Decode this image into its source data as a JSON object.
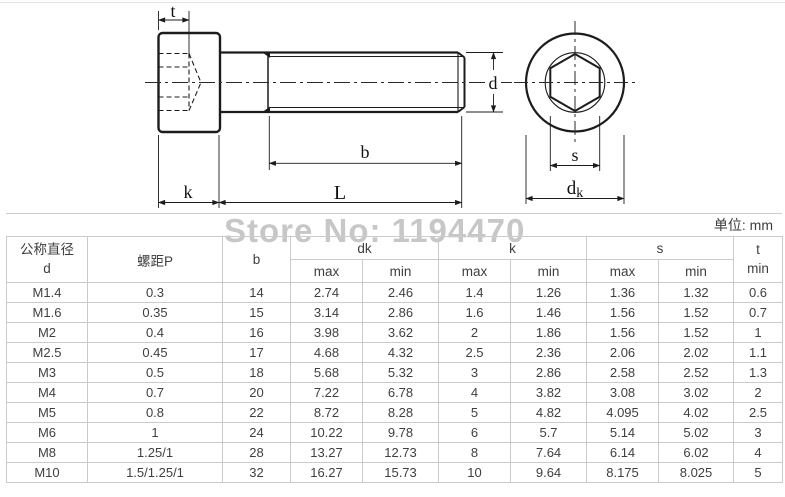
{
  "watermark": {
    "text": "Store No: 1194470",
    "color": "#c7c7c7"
  },
  "units_note": "单位: mm",
  "drawing": {
    "labels": {
      "t": "t",
      "k": "k",
      "l": "L",
      "b": "b",
      "d": "d",
      "s": "s",
      "dk_main": "d",
      "dk_sub": "k"
    }
  },
  "table": {
    "header": {
      "diameter_line1": "公称直径",
      "diameter_line2": "d",
      "pitch": "螺距P",
      "b": "b",
      "group_dk": "dk",
      "group_k": "k",
      "group_s": "s",
      "t_line1": "t",
      "t_line2": "min",
      "max_label": "max",
      "min_label": "min"
    },
    "rows": [
      [
        "M1.4",
        "0.3",
        "14",
        "2.74",
        "2.46",
        "1.4",
        "1.26",
        "1.36",
        "1.32",
        "0.6"
      ],
      [
        "M1.6",
        "0.35",
        "15",
        "3.14",
        "2.86",
        "1.6",
        "1.46",
        "1.56",
        "1.52",
        "0.7"
      ],
      [
        "M2",
        "0.4",
        "16",
        "3.98",
        "3.62",
        "2",
        "1.86",
        "1.56",
        "1.52",
        "1"
      ],
      [
        "M2.5",
        "0.45",
        "17",
        "4.68",
        "4.32",
        "2.5",
        "2.36",
        "2.06",
        "2.02",
        "1.1"
      ],
      [
        "M3",
        "0.5",
        "18",
        "5.68",
        "5.32",
        "3",
        "2.86",
        "2.58",
        "2.52",
        "1.3"
      ],
      [
        "M4",
        "0.7",
        "20",
        "7.22",
        "6.78",
        "4",
        "3.82",
        "3.08",
        "3.02",
        "2"
      ],
      [
        "M5",
        "0.8",
        "22",
        "8.72",
        "8.28",
        "5",
        "4.82",
        "4.095",
        "4.02",
        "2.5"
      ],
      [
        "M6",
        "1",
        "24",
        "10.22",
        "9.78",
        "6",
        "5.7",
        "5.14",
        "5.02",
        "3"
      ],
      [
        "M8",
        "1.25/1",
        "28",
        "13.27",
        "12.73",
        "8",
        "7.64",
        "6.14",
        "6.02",
        "4"
      ],
      [
        "M10",
        "1.5/1.25/1",
        "32",
        "16.27",
        "15.73",
        "10",
        "9.64",
        "8.175",
        "8.025",
        "5"
      ]
    ]
  }
}
